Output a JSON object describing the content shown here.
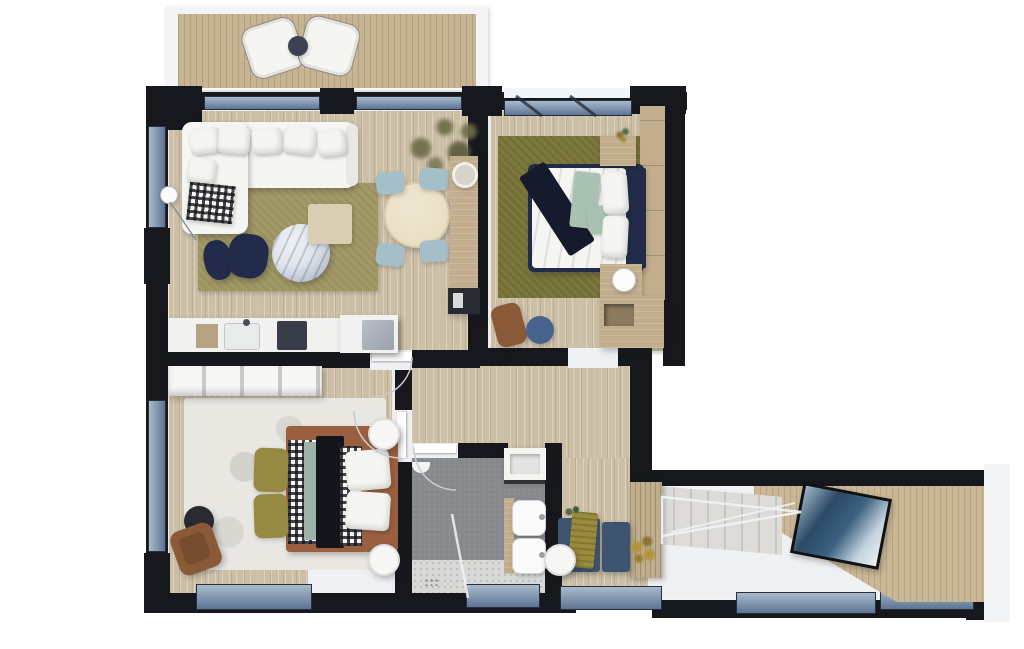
{
  "scene": {
    "type": "floor-plan-3d-render",
    "view": "top-down",
    "style": "photoreal architectural visualization on white background"
  },
  "colors": {
    "wall": "#16181d",
    "wall_inner": "#f3f4f6",
    "white_floor": "#eef0f2",
    "floor_wood": "#ccbfa6",
    "deck": "#c6b493",
    "wood_slat": "#bfae8c",
    "wood_furniture": "#c2ae8c",
    "wood_panel": "#c9b795",
    "rug_living": "#a39a67",
    "rug_master": "#7d783c",
    "rug_white": "#e9e7e2",
    "window_glass_light": "#a8bbcc",
    "window_glass_dark": "#5d7494",
    "window_frame": "#272e3d",
    "sofa_white": "#f5f5f2",
    "navy": "#222b49",
    "navy_dark": "#151b2c",
    "chair_blue": "#a4bfc7",
    "table_cream": "#eadfc4",
    "marble_light": "#eef1f4",
    "marble_dark": "#a9b3c2",
    "counter": "#f1f1f0",
    "cooktop": "#383d49",
    "appliance": "#9aa1ab",
    "tile": "#87898d",
    "speckle": "#d7d7d5",
    "terracotta": "#9a5f3e",
    "leather": "#8a5a38",
    "sage": "#a8c1b1",
    "olive": "#968a42",
    "gold": "#b3953b",
    "steel_blue": "#3f5470",
    "stool_blue": "#48648e",
    "black_furniture": "#2a2b30",
    "stairs": "#d6d5d1",
    "art_sea_dark": "#2b4a66",
    "art_sea_light": "#c2d3dd",
    "green_plant": "#4f6b4a",
    "tree_olive": "#6e6c48"
  },
  "rooms": [
    {
      "id": "balcony",
      "name": "balcony",
      "furniture": [
        "wood deck",
        "rattan lounge chair",
        "rattan lounge chair",
        "round side table",
        "glass railing"
      ]
    },
    {
      "id": "living-room",
      "name": "living room",
      "furniture": [
        "l-shaped white sofa",
        "throw pillows",
        "checkered plaid",
        "olive area rug",
        "round marble coffee table",
        "navy pouf",
        "navy pouf",
        "wood side table",
        "floor lamp"
      ]
    },
    {
      "id": "dining-area",
      "name": "dining area",
      "furniture": [
        "round dining table",
        "blue dining chair",
        "blue dining chair",
        "blue dining chair",
        "blue dining chair",
        "wood sideboard",
        "decor bowl",
        "black media unit",
        "potted tree"
      ]
    },
    {
      "id": "kitchen",
      "name": "kitchen",
      "furniture": [
        "kitchen counter",
        "sink with faucet",
        "cooktop",
        "cutting board",
        "built-in appliance"
      ]
    },
    {
      "id": "master-bedroom",
      "name": "master bedroom",
      "furniture": [
        "double bed",
        "white duvet",
        "navy throw",
        "sage blanket",
        "white pillows",
        "headboard",
        "nightstand with plant",
        "nightstand with lamp",
        "wardrobe",
        "cabinet with niche",
        "leather desk chair",
        "blue stool",
        "olive area rug"
      ]
    },
    {
      "id": "second-bedroom",
      "name": "second bedroom",
      "furniture": [
        "open shelving unit",
        "double bed",
        "gingham duvet",
        "black blanket",
        "white pillows",
        "olive ottoman",
        "olive ottoman",
        "round nightstand",
        "round nightstand",
        "leather armchair",
        "black side table",
        "white area rug"
      ]
    },
    {
      "id": "bathroom",
      "name": "bathroom",
      "furniture": [
        "walk-in shower",
        "glass screen",
        "shower head",
        "floor drain",
        "wall shelf",
        "washbasin",
        "washbasin",
        "wood vanity strip"
      ]
    },
    {
      "id": "hallway",
      "name": "hallway",
      "furniture": [
        "wood flooring",
        "door to living room",
        "door to second bedroom",
        "door to bathroom",
        "doorway to master bedroom"
      ]
    },
    {
      "id": "entry-hall",
      "name": "entry hall",
      "furniture": [
        "staircase",
        "glass balustrade",
        "wood slat wall",
        "blue bench",
        "gold towel",
        "round stool",
        "small plant",
        "blue cabinet",
        "dried flowers",
        "wood feature wall",
        "framed sea artwork"
      ]
    }
  ],
  "windows": [
    "living balcony glazing",
    "living balcony glazing",
    "master bedroom glazing",
    "living side window",
    "second bedroom side window",
    "second bedroom bottom window",
    "bathroom window",
    "hallway window",
    "entry window",
    "entry window"
  ]
}
